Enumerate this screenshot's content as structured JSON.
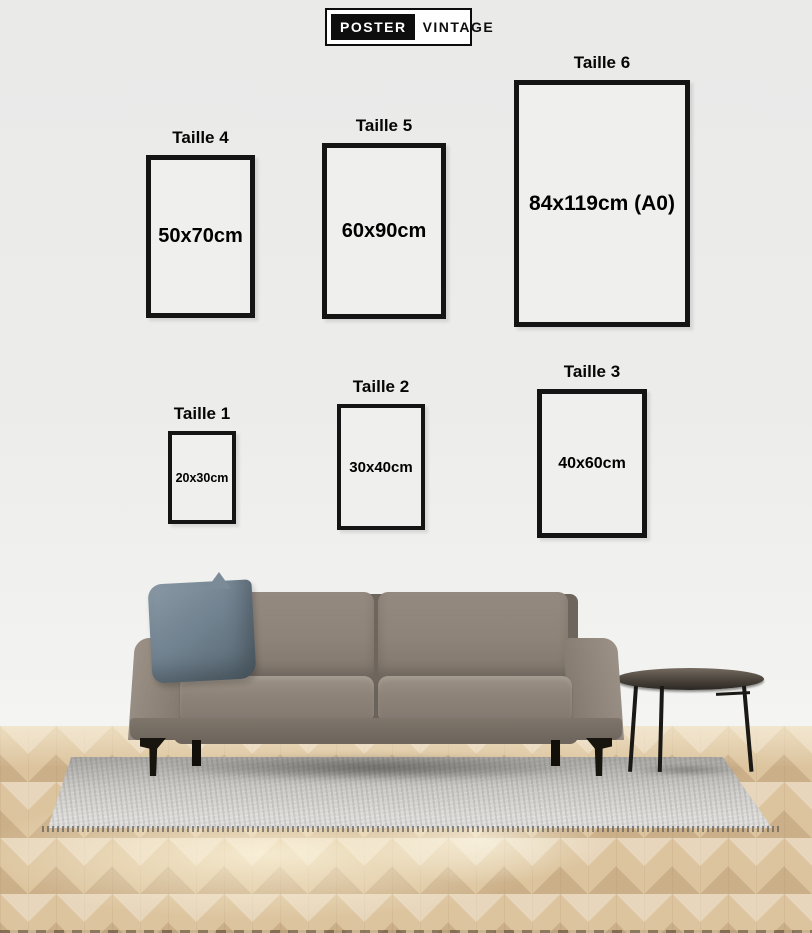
{
  "brand": {
    "poster": "POSTER",
    "vintage": "VINTAGE"
  },
  "frames": [
    {
      "label": "Taille 1",
      "size": "20x30cm"
    },
    {
      "label": "Taille 2",
      "size": "30x40cm"
    },
    {
      "label": "Taille 3",
      "size": "40x60cm"
    },
    {
      "label": "Taille 4",
      "size": "50x70cm"
    },
    {
      "label": "Taille 5",
      "size": "60x90cm"
    },
    {
      "label": "Taille 6",
      "size": "84x119cm (A0)"
    }
  ],
  "scene": {
    "objects": [
      "sofa",
      "cushion-pillow",
      "round-side-table",
      "rug",
      "herringbone-parquet-floor"
    ],
    "colors": {
      "wall": "#ececeb",
      "frame_border": "#141414",
      "frame_fill": "#efefee",
      "floor_wood": "#dcc49e",
      "rug": "#d9d8d5",
      "sofa": "#8d8378",
      "pillow": "#70818f",
      "table_top": "#3a342d",
      "legs_metal": "#18150f",
      "logo_black": "#0e0e0e",
      "logo_white": "#ffffff",
      "text": "#000000"
    }
  }
}
